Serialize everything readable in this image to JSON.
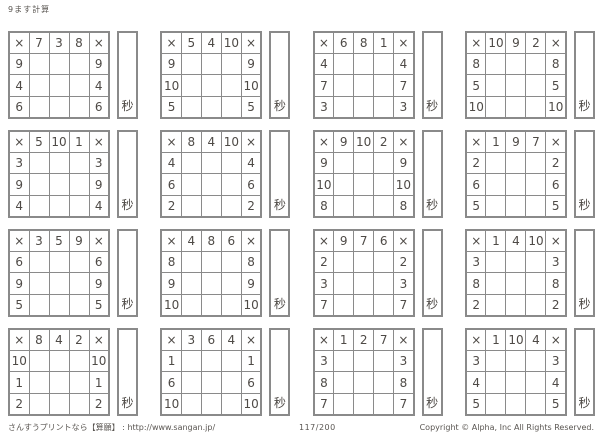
{
  "page": {
    "title": "9ます計算",
    "operator": "×",
    "seconds_label": "秒",
    "footer": {
      "left": "さんすうプリントなら【算願】 : http://www.sangan.jp/",
      "center": "117/200",
      "right": "Copyright © Alpha, Inc All Rights Reserved."
    }
  },
  "colors": {
    "grid_line": "#8a8a8a",
    "text": "#4e4a46"
  },
  "grids": [
    {
      "top": [
        7,
        3,
        8
      ],
      "left": [
        9,
        4,
        6
      ]
    },
    {
      "top": [
        5,
        4,
        10
      ],
      "left": [
        9,
        10,
        5
      ]
    },
    {
      "top": [
        6,
        8,
        1
      ],
      "left": [
        4,
        7,
        3
      ]
    },
    {
      "top": [
        10,
        9,
        2
      ],
      "left": [
        8,
        5,
        10
      ]
    },
    {
      "top": [
        5,
        10,
        1
      ],
      "left": [
        3,
        9,
        4
      ]
    },
    {
      "top": [
        8,
        4,
        10
      ],
      "left": [
        4,
        6,
        2
      ]
    },
    {
      "top": [
        9,
        10,
        2
      ],
      "left": [
        9,
        10,
        8
      ]
    },
    {
      "top": [
        1,
        9,
        7
      ],
      "left": [
        2,
        6,
        5
      ]
    },
    {
      "top": [
        3,
        5,
        9
      ],
      "left": [
        6,
        9,
        5
      ]
    },
    {
      "top": [
        4,
        8,
        6
      ],
      "left": [
        8,
        9,
        10
      ]
    },
    {
      "top": [
        9,
        7,
        6
      ],
      "left": [
        2,
        3,
        7
      ]
    },
    {
      "top": [
        1,
        4,
        10
      ],
      "left": [
        3,
        8,
        2
      ]
    },
    {
      "top": [
        8,
        4,
        2
      ],
      "left": [
        10,
        1,
        2
      ]
    },
    {
      "top": [
        3,
        6,
        4
      ],
      "left": [
        1,
        6,
        10
      ]
    },
    {
      "top": [
        1,
        2,
        7
      ],
      "left": [
        3,
        8,
        7
      ]
    },
    {
      "top": [
        1,
        10,
        4
      ],
      "left": [
        3,
        4,
        5
      ]
    }
  ]
}
